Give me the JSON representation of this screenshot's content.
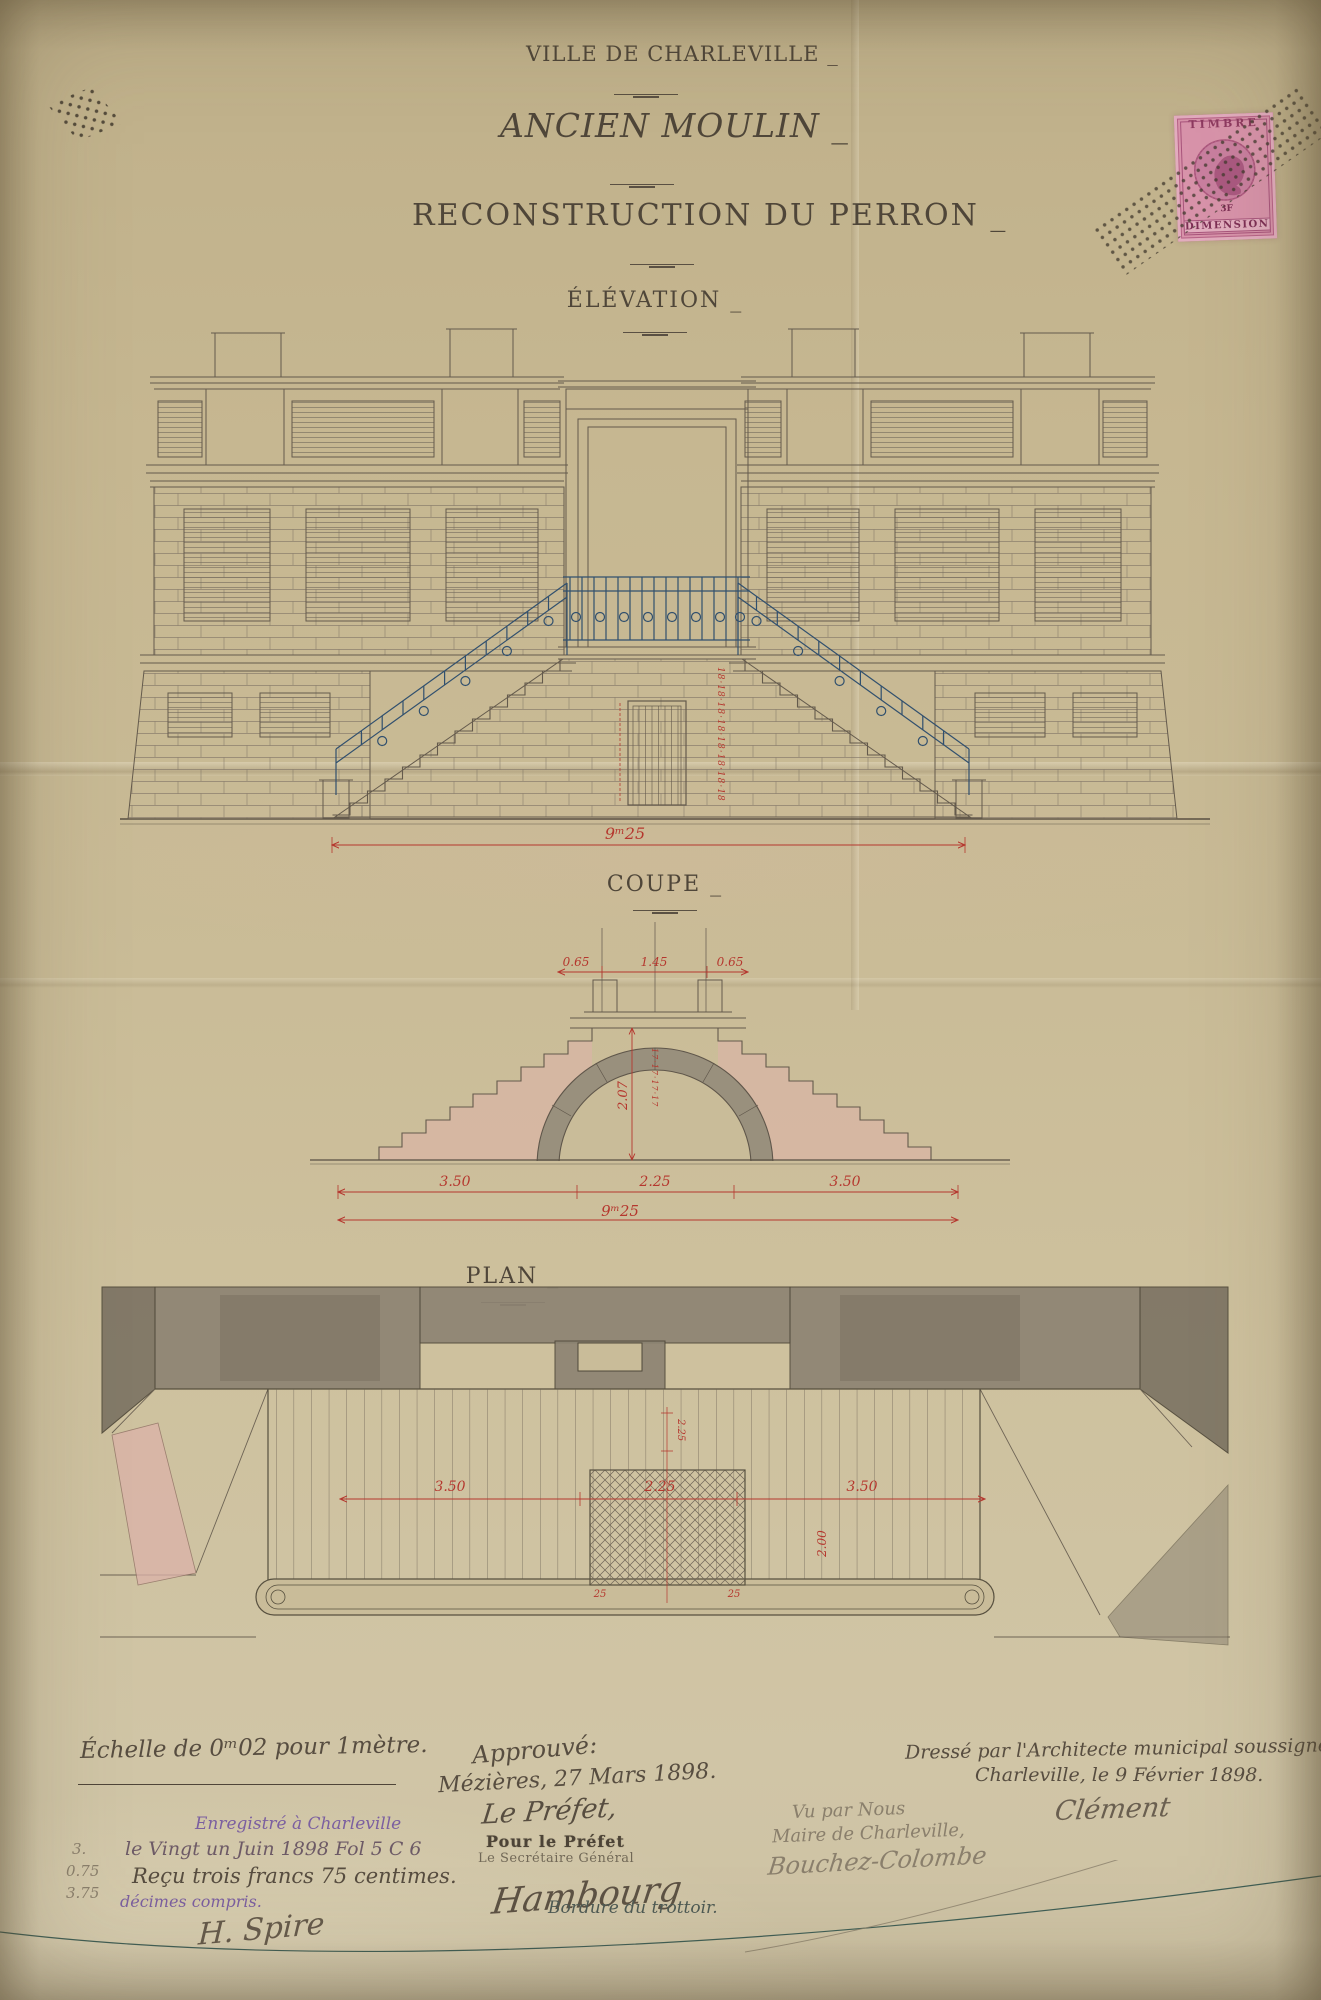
{
  "header": {
    "line1": "VILLE DE CHARLEVILLE _",
    "line2": "ANCIEN MOULIN _",
    "line3": "RECONSTRUCTION DU PERRON _"
  },
  "labels": {
    "elevation": "ÉLÉVATION _",
    "coupe": "COUPE _",
    "plan": "PLAN _"
  },
  "stamp": {
    "top": "TIMBRE",
    "value": "3F",
    "bottom": "DIMENSION"
  },
  "elevation": {
    "total_width": "9ᵐ25",
    "riser_marks": "18·18·18·18·18·18·18·18"
  },
  "coupe": {
    "dims_top": [
      "0.65",
      "1.45",
      "0.65"
    ],
    "arch_height": "2.07",
    "riser_marks": "17·17·17·17",
    "dims_bottom": [
      "3.50",
      "2.25",
      "3.50"
    ],
    "total_width": "9ᵐ25"
  },
  "plan": {
    "dims": [
      "3.50",
      "2.25",
      "3.50"
    ],
    "center_width": "2.25",
    "depth": "2.00",
    "grille_marks": [
      "25",
      "25"
    ]
  },
  "scale_note": {
    "text": "Échelle de 0ᵐ02 pour 1mètre."
  },
  "registration": {
    "line1": "Enregistré à Charleville",
    "line2": "le Vingt un Juin 1898 Fol 5 C 6",
    "line3": "Reçu trois francs 75 centimes.",
    "line4": "décimes compris.",
    "margin": [
      "3.",
      "0.75",
      "3.75"
    ],
    "signature": "H. Spire"
  },
  "approval": {
    "line1": "Approuvé:",
    "line2": "Mézières, 27 Mars 1898.",
    "line3": "Le Préfet,",
    "stamp1": "Pour le Préfet",
    "stamp2": "Le Secrétaire Général",
    "signature": "Hambourg"
  },
  "architect": {
    "line1": "Dressé par l'Architecte municipal soussigné.",
    "line2": "Charleville, le 9 Février 1898.",
    "signature": "Clément"
  },
  "mayor": {
    "line1": "Vu par Nous",
    "line2": "Maire de Charleville,",
    "signature": "Bouchez-Colombe"
  },
  "footer": {
    "bordure": "Bordure du trottoir."
  },
  "colors": {
    "paper": "#c8ba95",
    "ink": "#5a5043",
    "red": "#b5372e",
    "blue": "#31506e",
    "pink": "#dcb2a9",
    "gray_wash": "#8d8473",
    "purple": "#7b5fa0",
    "stamp_pink": "#d893aa"
  }
}
